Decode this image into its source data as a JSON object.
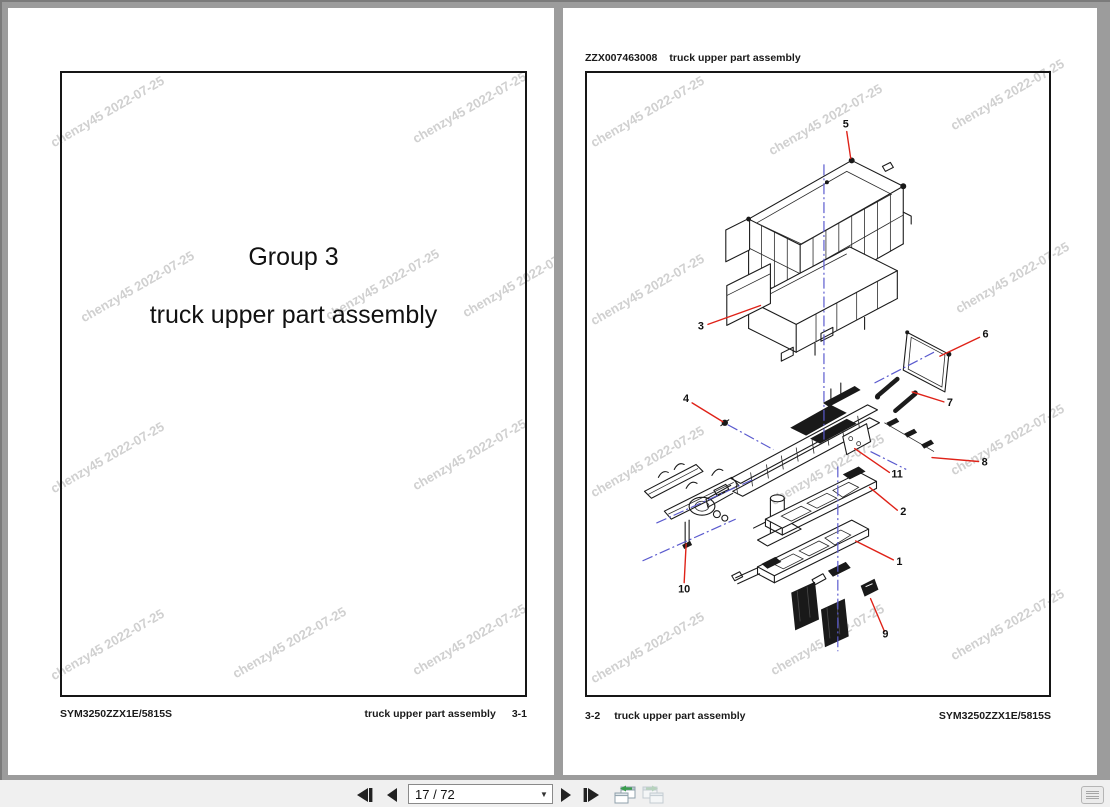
{
  "left_page": {
    "title_line1": "Group 3",
    "title_line2": "truck upper part assembly",
    "footer_left": "SYM3250ZZX1E/5815S",
    "footer_center": "truck upper part assembly",
    "footer_page": "3-1"
  },
  "right_page": {
    "header_code": "ZZX007463008",
    "header_title": "truck upper part assembly",
    "footer_page": "3-2",
    "footer_title": "truck upper part assembly",
    "footer_code": "SYM3250ZZX1E/5815S"
  },
  "watermark": {
    "text": "chenzy45 2022-07-25",
    "color": "#c8c8c8"
  },
  "diagram": {
    "callouts": [
      {
        "label": "1"
      },
      {
        "label": "2"
      },
      {
        "label": "3"
      },
      {
        "label": "4"
      },
      {
        "label": "5"
      },
      {
        "label": "6"
      },
      {
        "label": "7"
      },
      {
        "label": "8"
      },
      {
        "label": "9"
      },
      {
        "label": "10"
      },
      {
        "label": "11"
      }
    ],
    "leader_color": "#df2218",
    "centerline_color": "#5a5ace",
    "line_color": "#1a1a1a"
  },
  "toolbar": {
    "page_indicator": "17 / 72",
    "icons": [
      "first-page-icon",
      "previous-page-icon",
      "page-number-input",
      "next-page-icon",
      "last-page-icon",
      "previous-view-icon",
      "next-view-icon",
      "page-list-icon"
    ]
  }
}
